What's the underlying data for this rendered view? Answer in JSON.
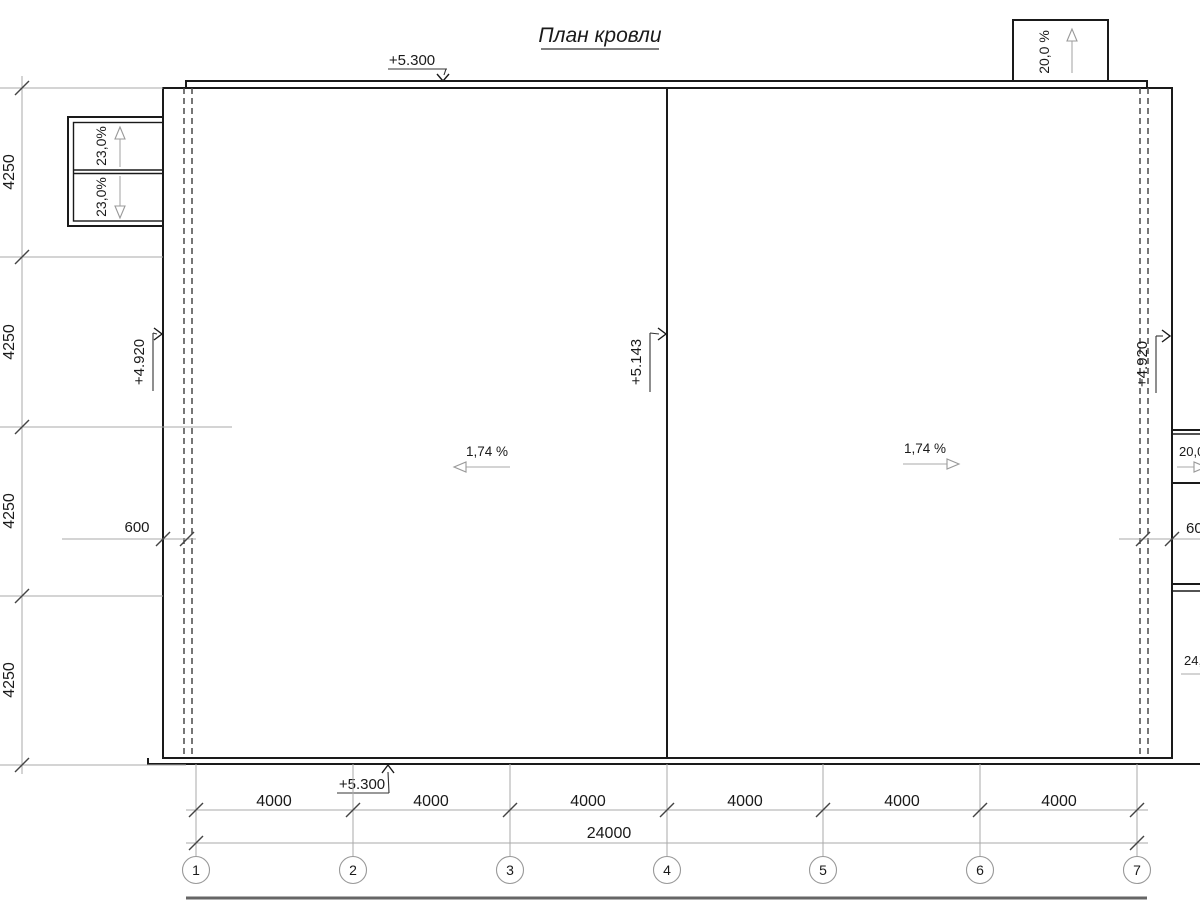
{
  "drawing": {
    "title": "План кровли"
  },
  "elevations": {
    "top": "+5.300",
    "bottom": "+5.300",
    "ridge": "+5.143",
    "left_eave": "+4.920",
    "right_eave": "+4.920"
  },
  "slopes": {
    "main_left": "1,74 %",
    "main_right": "1,74 %",
    "left_canopy_upper": "23,0%",
    "left_canopy_lower": "23,0%",
    "top_canopy": "20,0 %",
    "right_canopy": "20,0",
    "right_lower": "24,"
  },
  "dims": {
    "parapet_left": "600",
    "parapet_right": "600",
    "left_chain": [
      "4250",
      "4250",
      "4250",
      "4250"
    ],
    "bottom_chain": [
      "4000",
      "4000",
      "4000",
      "4000",
      "4000",
      "4000"
    ],
    "total": "24000"
  },
  "axes": [
    "1",
    "2",
    "3",
    "4",
    "5",
    "6",
    "7"
  ]
}
